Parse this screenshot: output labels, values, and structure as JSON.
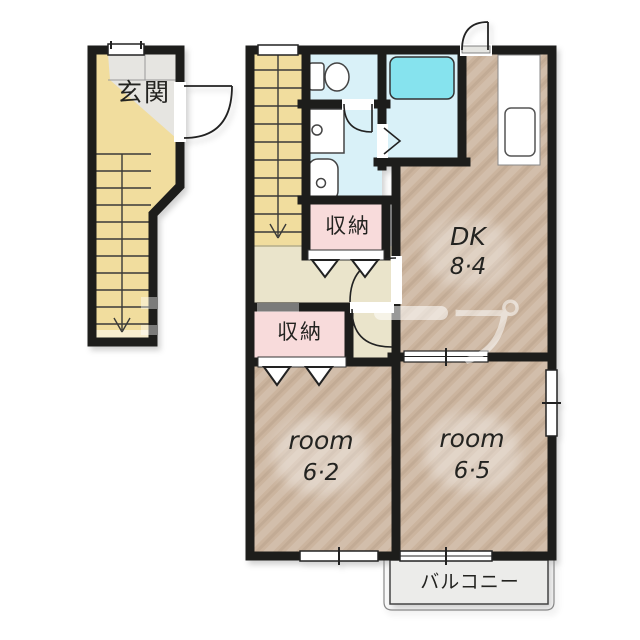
{
  "floorplan": {
    "entrance": {
      "label": "玄関"
    },
    "stairs": {
      "direction_note": "↓"
    },
    "storage_upper": {
      "label": "収納"
    },
    "storage_lower": {
      "label": "収納"
    },
    "dk": {
      "label": "DK",
      "size": "8·4"
    },
    "room_left": {
      "label": "room",
      "size": "6·2"
    },
    "room_right": {
      "label": "room",
      "size": "6·5"
    },
    "balcony": {
      "label": "バルコニー"
    },
    "watermark": {
      "visible_fragment": "ープ",
      "char": "プ"
    },
    "colors": {
      "wall": "#1d1d1b",
      "stairs_floor": "#f1dd9e",
      "entrance_tile": "#e6e5e1",
      "wet_area_floor": "#d9f1f8",
      "bathtub": "#86e3ee",
      "wood_floor": "#cbb49e",
      "hallway_floor": "#eae4cb",
      "storage_floor": "#f8dbdb",
      "balcony_floor": "#ececea"
    }
  }
}
